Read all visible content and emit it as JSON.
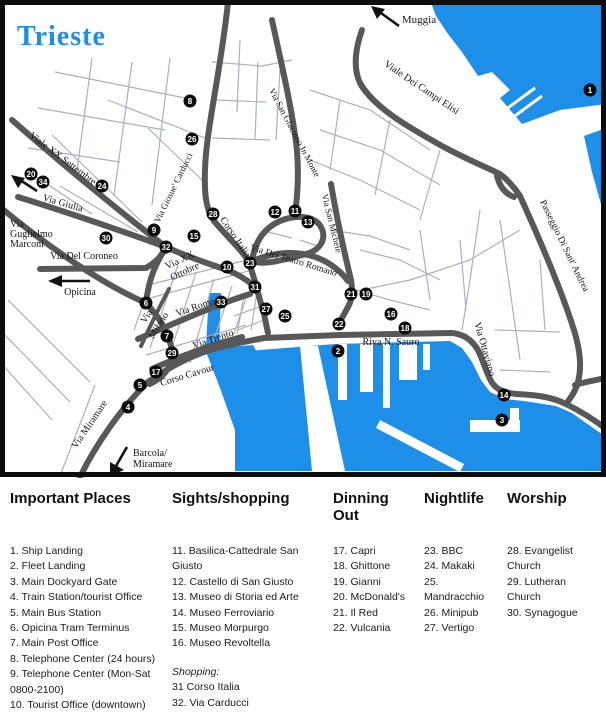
{
  "map": {
    "title": "Trieste",
    "colors": {
      "water": "#1e8fe8",
      "main_road": "#585858",
      "minor_street": "#aab1bd",
      "title_blue": "#1b8cf0",
      "marker": "#0b0b0b"
    },
    "street_labels": [
      {
        "text": "Muggia",
        "x": 419,
        "y": 23,
        "r": 0,
        "s": 11
      },
      {
        "text": "Viale XX Settembre",
        "x": 61,
        "y": 161,
        "r": 37,
        "s": 10
      },
      {
        "text": "Via Giulia",
        "x": 62,
        "y": 206,
        "r": 16,
        "s": 10
      },
      {
        "text": "Via",
        "x": 10,
        "y": 227,
        "r": 0,
        "s": 10,
        "a": "start"
      },
      {
        "text": "Guglielmo",
        "x": 10,
        "y": 237,
        "r": 0,
        "s": 10,
        "a": "start"
      },
      {
        "text": "Marconi",
        "x": 10,
        "y": 247,
        "r": 0,
        "s": 10,
        "a": "start"
      },
      {
        "text": "Via Del Coroneo",
        "x": 84,
        "y": 259,
        "r": 0,
        "s": 10
      },
      {
        "text": "Opicina",
        "x": 80,
        "y": 295,
        "r": 0,
        "s": 10
      },
      {
        "text": "Via Miramare",
        "x": 92,
        "y": 426,
        "r": -56,
        "s": 10
      },
      {
        "text": "Barcola/",
        "x": 133,
        "y": 456,
        "r": 0,
        "s": 10,
        "a": "start"
      },
      {
        "text": "Miramare",
        "x": 133,
        "y": 467,
        "r": 0,
        "s": 10,
        "a": "start"
      },
      {
        "text": "Corso Cavour",
        "x": 188,
        "y": 378,
        "r": -17,
        "s": 10
      },
      {
        "text": "Via Trento",
        "x": 214,
        "y": 342,
        "r": -19,
        "s": 10
      },
      {
        "text": "Via Roma",
        "x": 196,
        "y": 310,
        "r": -19,
        "s": 10
      },
      {
        "text": "Via",
        "x": 149,
        "y": 318,
        "r": -58,
        "s": 10
      },
      {
        "text": "Milano",
        "x": 161,
        "y": 327,
        "r": -58,
        "s": 10
      },
      {
        "text": "Via XX",
        "x": 181,
        "y": 263,
        "r": -25,
        "s": 10
      },
      {
        "text": "Ottobre",
        "x": 186,
        "y": 274,
        "r": -25,
        "s": 10
      },
      {
        "text": "Corso Italia",
        "x": 233,
        "y": 239,
        "r": 56,
        "s": 10
      },
      {
        "text": "Via Giosue' Carducci",
        "x": 176,
        "y": 189,
        "r": -64,
        "s": 9
      },
      {
        "text": "Via San Giacomo In Monte",
        "x": 292,
        "y": 134,
        "r": 62,
        "s": 9
      },
      {
        "text": "Via San Michele",
        "x": 329,
        "y": 224,
        "r": 76,
        "s": 9
      },
      {
        "text": "Via Del Teatro Romano",
        "x": 293,
        "y": 263,
        "r": 17,
        "s": 9.5
      },
      {
        "text": "Viale Dei Campi Elisi",
        "x": 420,
        "y": 90,
        "r": 34,
        "s": 10
      },
      {
        "text": "Passeggio Di Sant' Andrea",
        "x": 562,
        "y": 247,
        "r": 64,
        "s": 9.5
      },
      {
        "text": "Riva N. Sauro",
        "x": 391,
        "y": 345,
        "r": 0,
        "s": 10
      },
      {
        "text": "Via Ottaviano",
        "x": 482,
        "y": 350,
        "r": 74,
        "s": 10
      }
    ],
    "markers": [
      {
        "n": "1",
        "x": 590,
        "y": 90
      },
      {
        "n": "2",
        "x": 338,
        "y": 351
      },
      {
        "n": "3",
        "x": 502,
        "y": 420
      },
      {
        "n": "4",
        "x": 128,
        "y": 407
      },
      {
        "n": "5",
        "x": 140,
        "y": 385
      },
      {
        "n": "6",
        "x": 146,
        "y": 303
      },
      {
        "n": "7",
        "x": 167,
        "y": 336
      },
      {
        "n": "8",
        "x": 190,
        "y": 101
      },
      {
        "n": "9",
        "x": 154,
        "y": 230
      },
      {
        "n": "10",
        "x": 227,
        "y": 267
      },
      {
        "n": "11",
        "x": 295,
        "y": 211
      },
      {
        "n": "12",
        "x": 275,
        "y": 212
      },
      {
        "n": "13",
        "x": 308,
        "y": 222
      },
      {
        "n": "14",
        "x": 504,
        "y": 395
      },
      {
        "n": "15",
        "x": 194,
        "y": 236
      },
      {
        "n": "16",
        "x": 391,
        "y": 314
      },
      {
        "n": "17",
        "x": 156,
        "y": 372
      },
      {
        "n": "18",
        "x": 405,
        "y": 328
      },
      {
        "n": "19",
        "x": 366,
        "y": 294
      },
      {
        "n": "20",
        "x": 31,
        "y": 174
      },
      {
        "n": "21",
        "x": 351,
        "y": 294
      },
      {
        "n": "22",
        "x": 339,
        "y": 324
      },
      {
        "n": "23",
        "x": 250,
        "y": 263
      },
      {
        "n": "24",
        "x": 102,
        "y": 186
      },
      {
        "n": "25",
        "x": 285,
        "y": 316
      },
      {
        "n": "26",
        "x": 192,
        "y": 139
      },
      {
        "n": "27",
        "x": 266,
        "y": 309
      },
      {
        "n": "28",
        "x": 213,
        "y": 214
      },
      {
        "n": "29",
        "x": 172,
        "y": 353
      },
      {
        "n": "30",
        "x": 106,
        "y": 238
      },
      {
        "n": "31",
        "x": 255,
        "y": 287
      },
      {
        "n": "32",
        "x": 166,
        "y": 247
      },
      {
        "n": "33",
        "x": 221,
        "y": 302
      },
      {
        "n": "34",
        "x": 43,
        "y": 182
      }
    ]
  },
  "legend": {
    "columns": [
      {
        "title": "Important Places",
        "items": [
          "1. Ship Landing",
          "2. Fleet Landing",
          "3. Main Dockyard Gate",
          "4. Train Station/tourist Office",
          "5. Main Bus Station",
          "6. Opicina Tram Terminus",
          "7. Main Post Office",
          "8. Telephone Center (24 hours)",
          "9. Telephone Center (Mon-Sat 0800-2100)",
          "10. Tourist Office (downtown)"
        ]
      },
      {
        "title": "Sights/shopping",
        "items": [
          "11. Basilica-Cattedrale San Giusto",
          "12. Castello di San Giusto",
          "13. Museo di Storia ed Arte",
          "14. Museo Ferroviario",
          "15. Museo Morpurgo",
          "16. Museo Revoltella"
        ],
        "note": "Shopping:",
        "note_items": [
          "31 Corso Italia",
          "32. Via Carducci",
          "33. Mercado Ponterosso",
          "34 Giulia Mall"
        ]
      },
      {
        "title": "Dinning Out",
        "items": [
          "17. Capri",
          "18. Ghittone",
          "19. Gianni",
          "20. McDonald's",
          "21. Il Red",
          "22. Vulcania"
        ]
      },
      {
        "title": "Nightlife",
        "items": [
          "23. BBC",
          "24. Makaki",
          "25. Mandracchio",
          "26. Minipub",
          "27. Vertigo"
        ]
      },
      {
        "title": "Worship",
        "items": [
          "28. Evangelist Church",
          "29. Lutheran Church",
          "30. Synagogue"
        ]
      }
    ]
  }
}
